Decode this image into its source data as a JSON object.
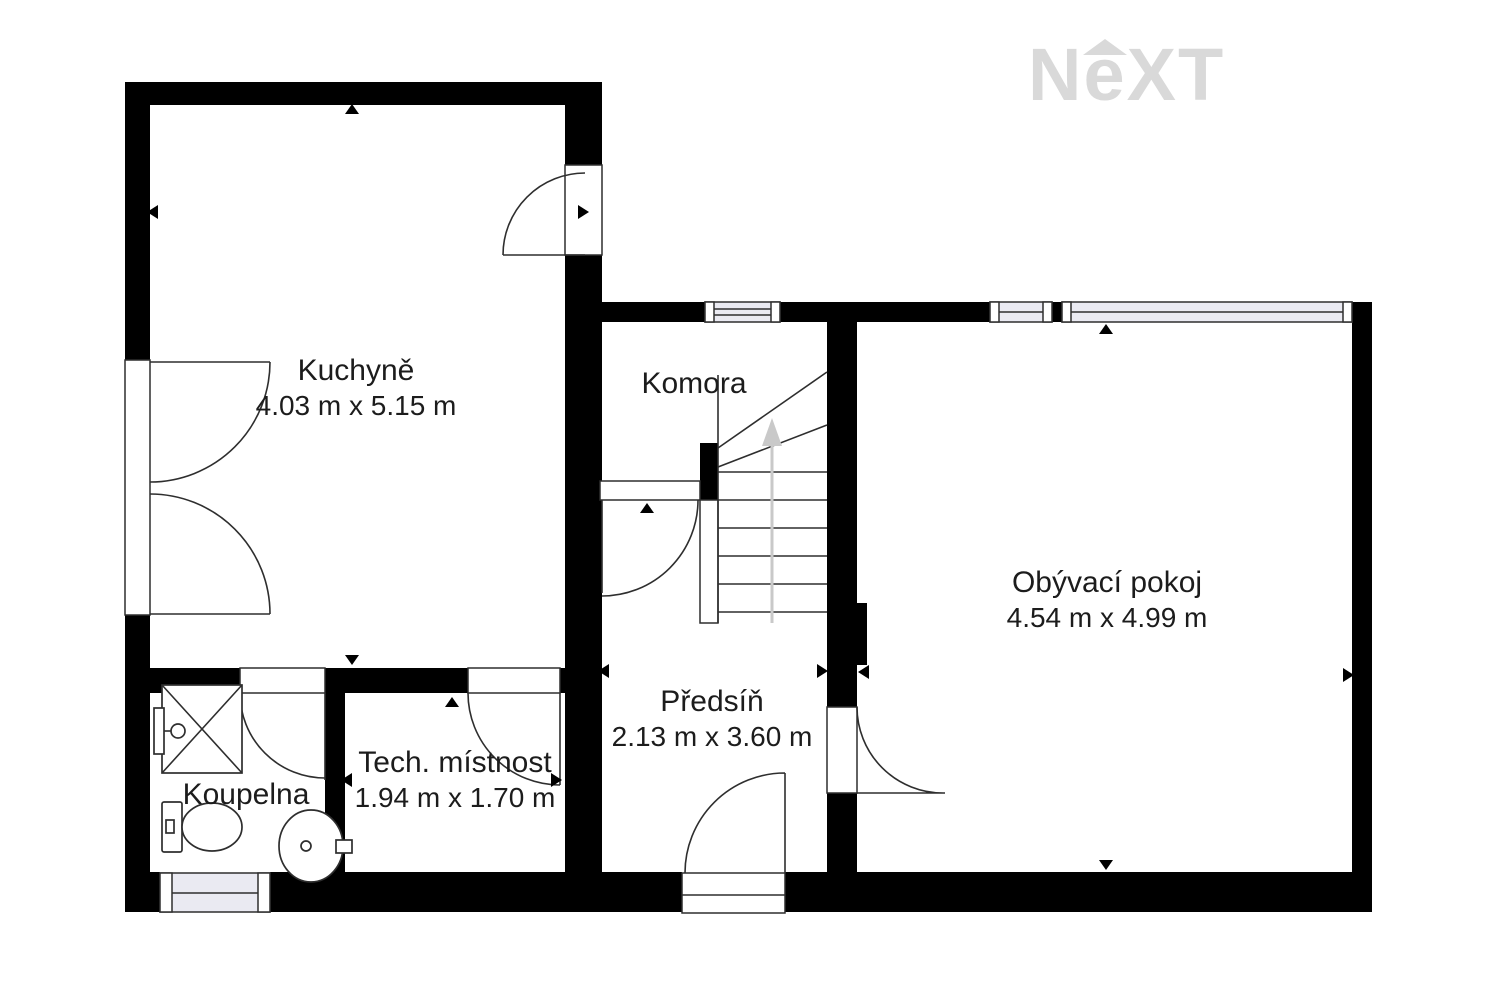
{
  "brand": {
    "logo_letters": [
      "N",
      "e",
      "X",
      "T"
    ]
  },
  "rooms": {
    "kuchyne": {
      "name": "Kuchyně",
      "dims": "4.03 m x 5.15 m"
    },
    "komora": {
      "name": "Komora"
    },
    "obyvaci_pokoj": {
      "name": "Obývací pokoj",
      "dims": "4.54 m x 4.99 m"
    },
    "predsin": {
      "name": "Předsíň",
      "dims": "2.13 m x 3.60 m"
    },
    "tech_mistnost": {
      "name": "Tech. místnost",
      "dims": "1.94 m x 1.70 m"
    },
    "koupelna": {
      "name": "Koupelna"
    }
  },
  "colors": {
    "background": "#ffffff",
    "wall": "#000000",
    "line": "#2e2e2e",
    "window_fill": "#eaeaf2",
    "logo_gray": "#d9d9d9",
    "stairs_arrow": "#c9c9c9",
    "text": "#1c1c1c"
  }
}
